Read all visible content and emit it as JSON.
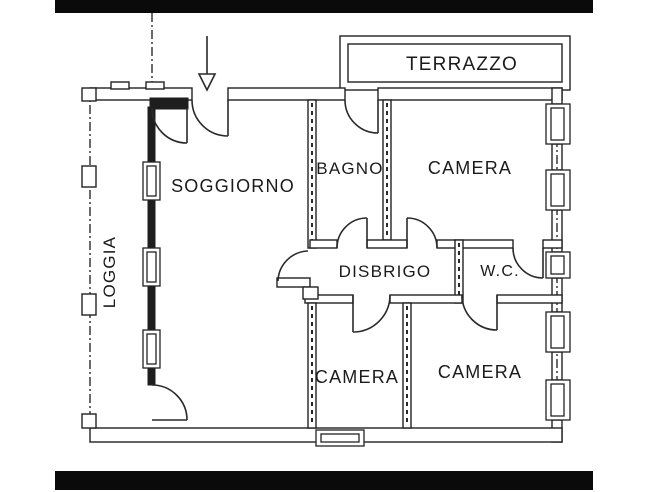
{
  "document": {
    "type": "scanned floor plan",
    "ink_color": "#222222",
    "paper_color": "#ffffff",
    "scan_bar_color": "#0a0a0a"
  },
  "labels": {
    "terrazzo": "TERRAZZO",
    "soggiorno": "SOGGIORNO",
    "bagno": "BAGNO",
    "camera_nord": "CAMERA",
    "loggia": "LOGGIA",
    "disbrigo": "DISBRIGO",
    "wc": "W.C.",
    "camera_sud_ovest": "CAMERA",
    "camera_sud_est": "CAMERA"
  },
  "rooms": [
    {
      "id": "terrazzo",
      "label": "TERRAZZO"
    },
    {
      "id": "soggiorno",
      "label": "SOGGIORNO"
    },
    {
      "id": "bagno",
      "label": "BAGNO"
    },
    {
      "id": "camera-nord",
      "label": "CAMERA"
    },
    {
      "id": "loggia",
      "label": "LOGGIA"
    },
    {
      "id": "disbrigo",
      "label": "DISBRIGO"
    },
    {
      "id": "wc",
      "label": "W.C."
    },
    {
      "id": "camera-sud-ovest",
      "label": "CAMERA"
    },
    {
      "id": "camera-sud-est",
      "label": "CAMERA"
    }
  ],
  "symbols": {
    "entrance_arrow": "arrow pointing down at main entrance",
    "windows_right_wall": 5,
    "windows_loggia_wall": 3,
    "windows_bottom_wall": 1,
    "door_arcs": 9
  }
}
